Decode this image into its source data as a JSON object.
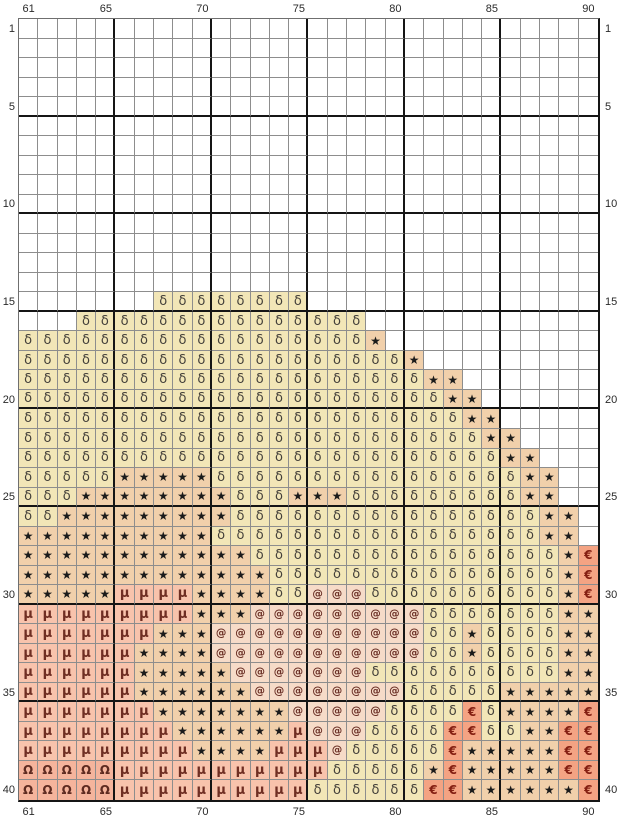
{
  "chart": {
    "type": "cross-stitch-pattern-grid",
    "columns": 30,
    "rows": 40,
    "first_column_number": 61,
    "last_column_number": 90,
    "first_row_number": 1,
    "last_row_number": 40,
    "bold_grid_every": 5
  },
  "axes": {
    "top": [
      {
        "label": "61",
        "col": 1
      },
      {
        "label": "65",
        "col": 5
      },
      {
        "label": "70",
        "col": 10
      },
      {
        "label": "75",
        "col": 15
      },
      {
        "label": "80",
        "col": 20
      },
      {
        "label": "85",
        "col": 25
      },
      {
        "label": "90",
        "col": 30
      }
    ],
    "bottom": [
      {
        "label": "61",
        "col": 1
      },
      {
        "label": "65",
        "col": 5
      },
      {
        "label": "70",
        "col": 10
      },
      {
        "label": "75",
        "col": 15
      },
      {
        "label": "80",
        "col": 20
      },
      {
        "label": "85",
        "col": 25
      },
      {
        "label": "90",
        "col": 30
      }
    ],
    "left": [
      {
        "label": "1",
        "row": 1
      },
      {
        "label": "5",
        "row": 5
      },
      {
        "label": "10",
        "row": 10
      },
      {
        "label": "15",
        "row": 15
      },
      {
        "label": "20",
        "row": 20
      },
      {
        "label": "25",
        "row": 25
      },
      {
        "label": "30",
        "row": 30
      },
      {
        "label": "35",
        "row": 35
      },
      {
        "label": "40",
        "row": 40
      }
    ],
    "right": [
      {
        "label": "1",
        "row": 1
      },
      {
        "label": "5",
        "row": 5
      },
      {
        "label": "10",
        "row": 10
      },
      {
        "label": "15",
        "row": 15
      },
      {
        "label": "20",
        "row": 20
      },
      {
        "label": "25",
        "row": 25
      },
      {
        "label": "30",
        "row": 30
      },
      {
        "label": "35",
        "row": 35
      },
      {
        "label": "40",
        "row": 40
      }
    ]
  },
  "legend": {
    ".": {
      "symbol": "",
      "name": "empty",
      "bg": "#ffffff",
      "fg": "#000000"
    },
    "d": {
      "symbol": "δ",
      "name": "delta-stitch",
      "bg": "#f2e6b7",
      "fg": "#44403a"
    },
    "s": {
      "symbol": "★",
      "name": "star-stitch",
      "bg": "#f1d0ab",
      "fg": "#1b1b1b"
    },
    "m": {
      "symbol": "μ",
      "name": "mu-stitch",
      "bg": "#f8c3ac",
      "fg": "#6f2e23"
    },
    "a": {
      "symbol": "@",
      "name": "at-stitch",
      "bg": "#f6dbc8",
      "fg": "#6b3026"
    },
    "o": {
      "symbol": "Ω",
      "name": "omega-stitch",
      "bg": "#f5b49c",
      "fg": "#5e2b21"
    },
    "e": {
      "symbol": "€",
      "name": "euro-stitch",
      "bg": "#f4a383",
      "fg": "#841f12"
    }
  },
  "pattern_rows": [
    "..............................",
    "..............................",
    "..............................",
    "..............................",
    "..............................",
    "..............................",
    "..............................",
    "..............................",
    "..............................",
    "..............................",
    "..............................",
    "..............................",
    "..............................",
    "..............................",
    ".......dddddddd...............",
    "...ddddddddddddddd............",
    "dddddddddddddddddds...........",
    "dddddddddddddddddddds.........",
    "dddddddddddddddddddddss.......",
    "ddddddddddddddddddddddss......",
    "dddddddddddddddddddddddss.....",
    "ddddddddddddddddddddddddss....",
    "dddddddddddddddddddddddddss...",
    "dddddsssssddddddddddddddddss..",
    "dddssssssssdddsssdddddddddss..",
    "ddsssssssssddddddddddddddddss.",
    "ssssssssssdddddddddddddddddss.",
    "ssssssssssssddddddddddddddddse",
    "sssssssssssssdddddddddddddddse",
    "sssssmmmmssssddaaaddddddddddse",
    "mmmmmmmmmsssaaaaaaaaadddddddss",
    "mmmmmmmsssaaaaaaaaaaaddsddddss",
    "mmmmmmssssaaaaaaaaaaaddsddddss",
    "mmmmmmsssssaaaaaaaddddddddddss",
    "mmmmmmssssssaaaaaaaadddddsssss",
    "mmmmmmmsssssssaaaaaddddedsssse",
    "mmmmmmmmssssssmaaaddddeeddssee",
    "mmmmmmmmmssssmmmadddddesssssee",
    "ooooommmmmmmmmmmdddddsesssssee",
    "ooooommmmmmmmmmddddddeesssssse"
  ],
  "colors": {
    "background": "#ffffff",
    "grid_line": "#8d8d8d",
    "bold_line": "#151515",
    "outer_thin_line": "#6f6f6f",
    "axis_label": "#2a2a2a"
  }
}
